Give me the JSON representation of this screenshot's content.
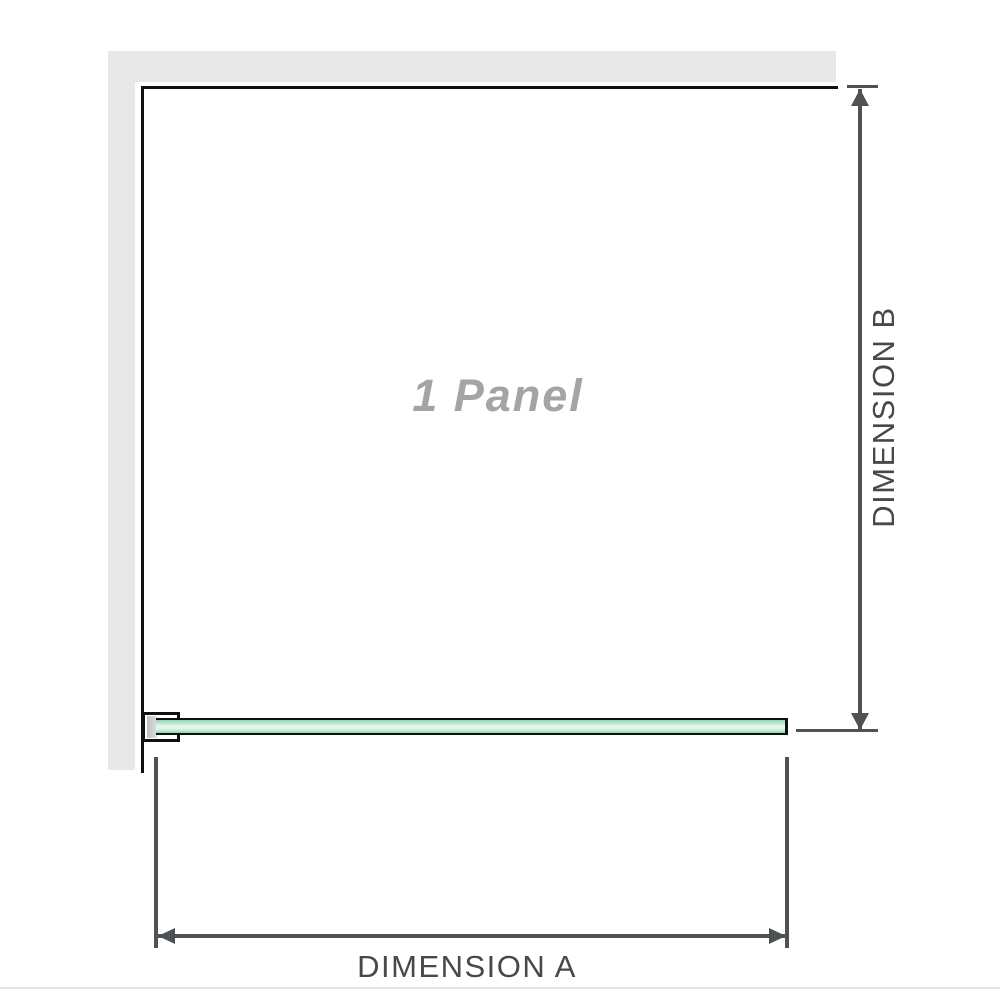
{
  "labels": {
    "panel": "1 Panel",
    "dimension_a": "DIMENSION A",
    "dimension_b": "DIMENSION B"
  },
  "icons": {
    "dimension_b_arrows": [
      "arrow-up-icon",
      "arrow-down-icon"
    ],
    "dimension_a_arrows": [
      "arrow-left-icon",
      "arrow-right-icon"
    ]
  },
  "colors": {
    "background": "#ffffff",
    "wall_fill": "#e8e8e8",
    "outline": "#101010",
    "dimension_line": "#4e5254",
    "dimension_text": "#46494c",
    "panel_label_text": "#a4a4a4",
    "glass_green_dark": "#96d2b2",
    "glass_green_mid": "#c8ebd8",
    "glass_green_light": "#ecf8f1",
    "baseline": "#e7e5e0"
  }
}
